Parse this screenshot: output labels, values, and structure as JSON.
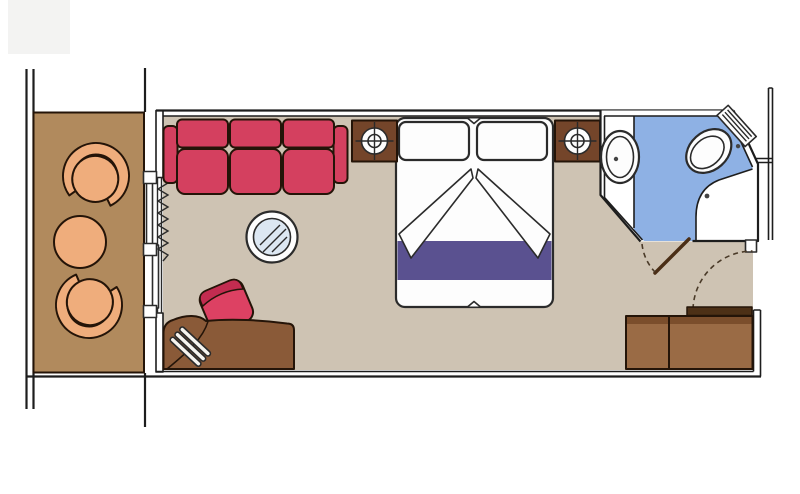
{
  "meta": {
    "title": "Cabin floor plan",
    "kind": "floor-plan",
    "has_text": false
  },
  "colors": {
    "background": "#ffffff",
    "wall_line": "#1d1d1d",
    "floor": "#cec3b3",
    "deck": "#b18a5d",
    "tan": "#efad7c",
    "sofa_red": "#d4405f",
    "stool_red": "#dd4163",
    "stool_rim": "#c22c50",
    "blanket_purple": "#5a5190",
    "bath_floor_blue": "#8eb1e4",
    "table_glass": "#dce7f2",
    "nightstand_brown": "#74452a",
    "desk_brown": "#8a5a38",
    "wardrobe_brown": "#9a6b45",
    "wardrobe_top_brown": "#7b4e2c",
    "door_leaf_brown": "#4d3016",
    "fixture_white": "#fdfdfd",
    "corner_gray": "#f3f3f2"
  },
  "rooms": [
    {
      "id": "balcony",
      "label": "Balcony with two chairs and table"
    },
    {
      "id": "cabin",
      "label": "Main cabin / sleeping and sitting area"
    },
    {
      "id": "bathroom",
      "label": "Bathroom with sink, toilet and shower"
    },
    {
      "id": "entry",
      "label": "Entry vestibule with wardrobe"
    }
  ],
  "furniture": [
    "balcony-chair-top",
    "balcony-chair-bottom",
    "balcony-table",
    "sliding-balcony-door",
    "curtain",
    "sofa",
    "coffee-table",
    "stool",
    "desk",
    "hairdryer",
    "double-bed",
    "pillow-left",
    "pillow-right",
    "bed-runner",
    "nightstand-left",
    "lamp-left",
    "nightstand-right",
    "lamp-right",
    "vanity-sink",
    "toilet",
    "shower",
    "bathroom-door",
    "entry-door",
    "wardrobe"
  ]
}
